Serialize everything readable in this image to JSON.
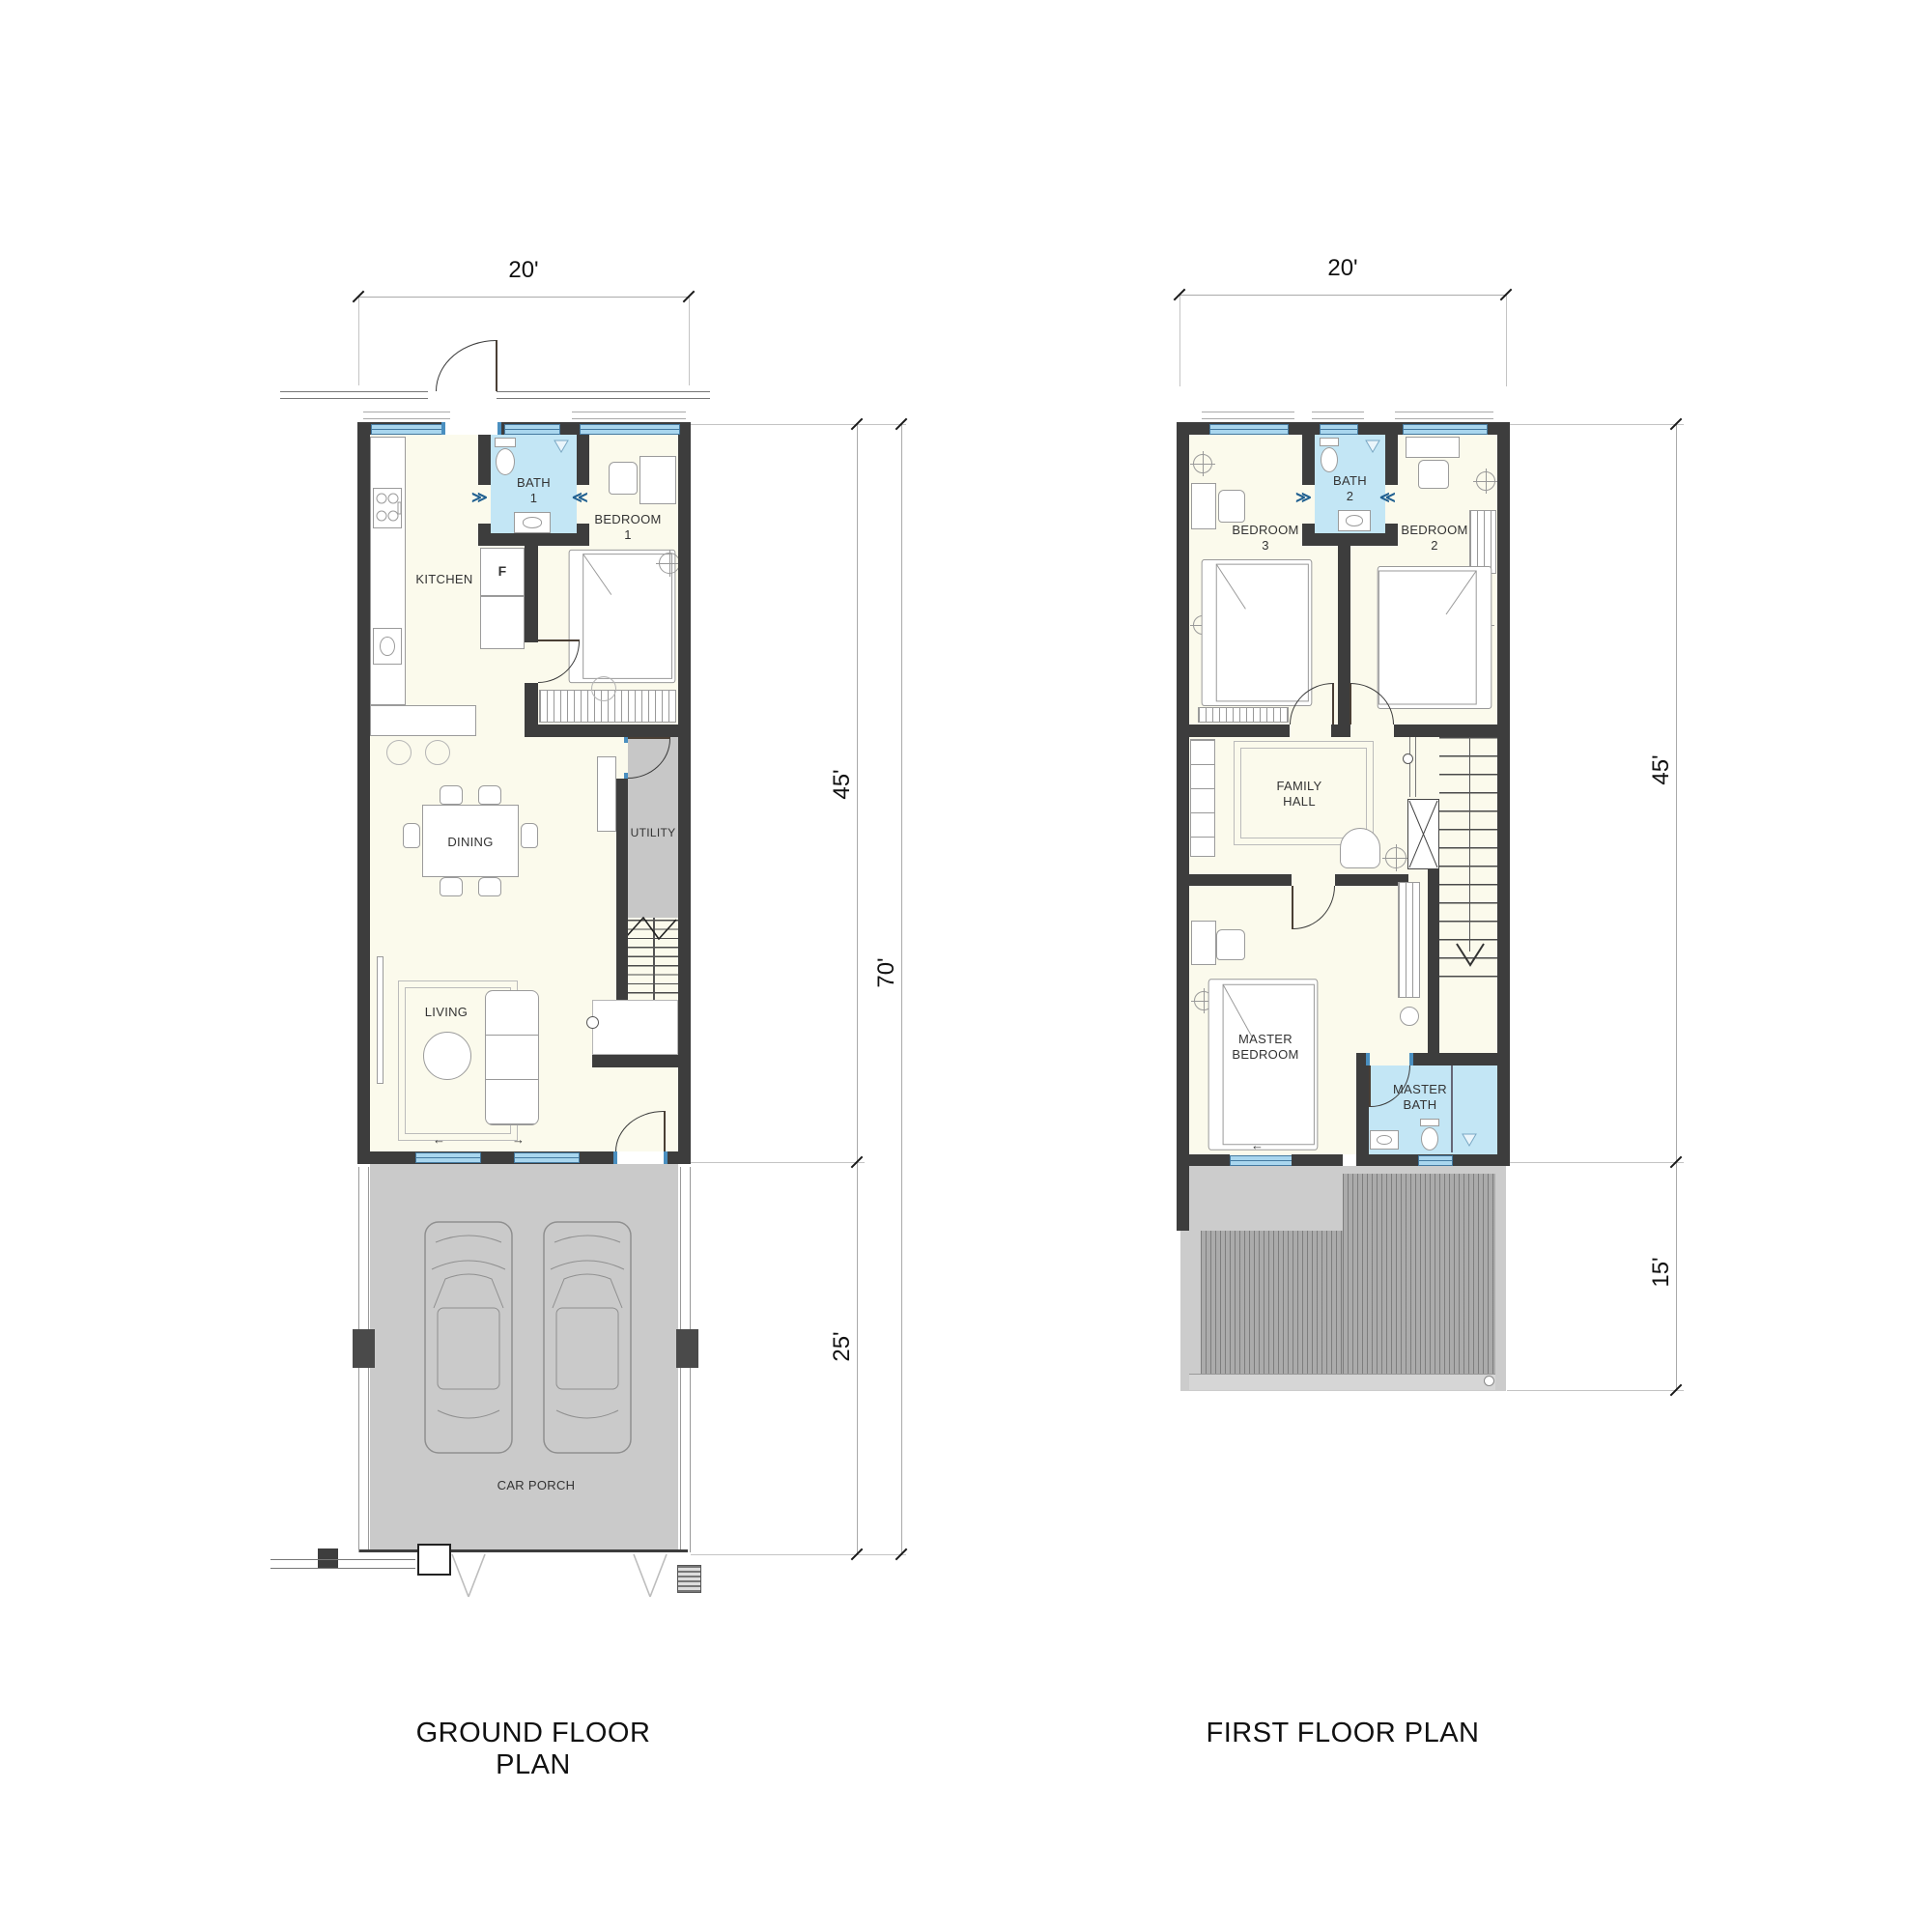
{
  "ground_floor": {
    "title": "GROUND FLOOR PLAN",
    "dimensions": {
      "width": "20'",
      "house_depth": "45'",
      "porch_depth": "25'",
      "total_depth": "70'"
    },
    "rooms": {
      "kitchen": "KITCHEN",
      "bath1": "BATH\n1",
      "bedroom1": "BEDROOM\n1",
      "fridge": "F",
      "dining": "DINING",
      "utility": "UTILITY",
      "living": "LIVING",
      "car_porch": "CAR PORCH"
    }
  },
  "first_floor": {
    "title": "FIRST FLOOR PLAN",
    "dimensions": {
      "width": "20'",
      "house_depth": "45'",
      "deck_depth": "15'"
    },
    "rooms": {
      "bedroom3": "BEDROOM\n3",
      "bath2": "BATH\n2",
      "bedroom2": "BEDROOM\n2",
      "family_hall": "FAMILY\nHALL",
      "master_bedroom": "MASTER\nBEDROOM",
      "master_bath": "MASTER\nBATH"
    }
  },
  "symbols": {
    "slide_left": "←",
    "slide_right": "→",
    "fold_door_right": "≫",
    "fold_door_left": "≪"
  },
  "colors": {
    "wall": "#3d3d3d",
    "room_fill": "#fbfaec",
    "bath_fill": "#c3e6f5",
    "window": "#a9d6ee",
    "window_frame": "#44799f",
    "utility_fill": "#c7c7c7",
    "porch_fill": "#cacaca",
    "deck_fill": "#ababab",
    "furniture_line": "#9b9b9b",
    "text": "#333333"
  }
}
